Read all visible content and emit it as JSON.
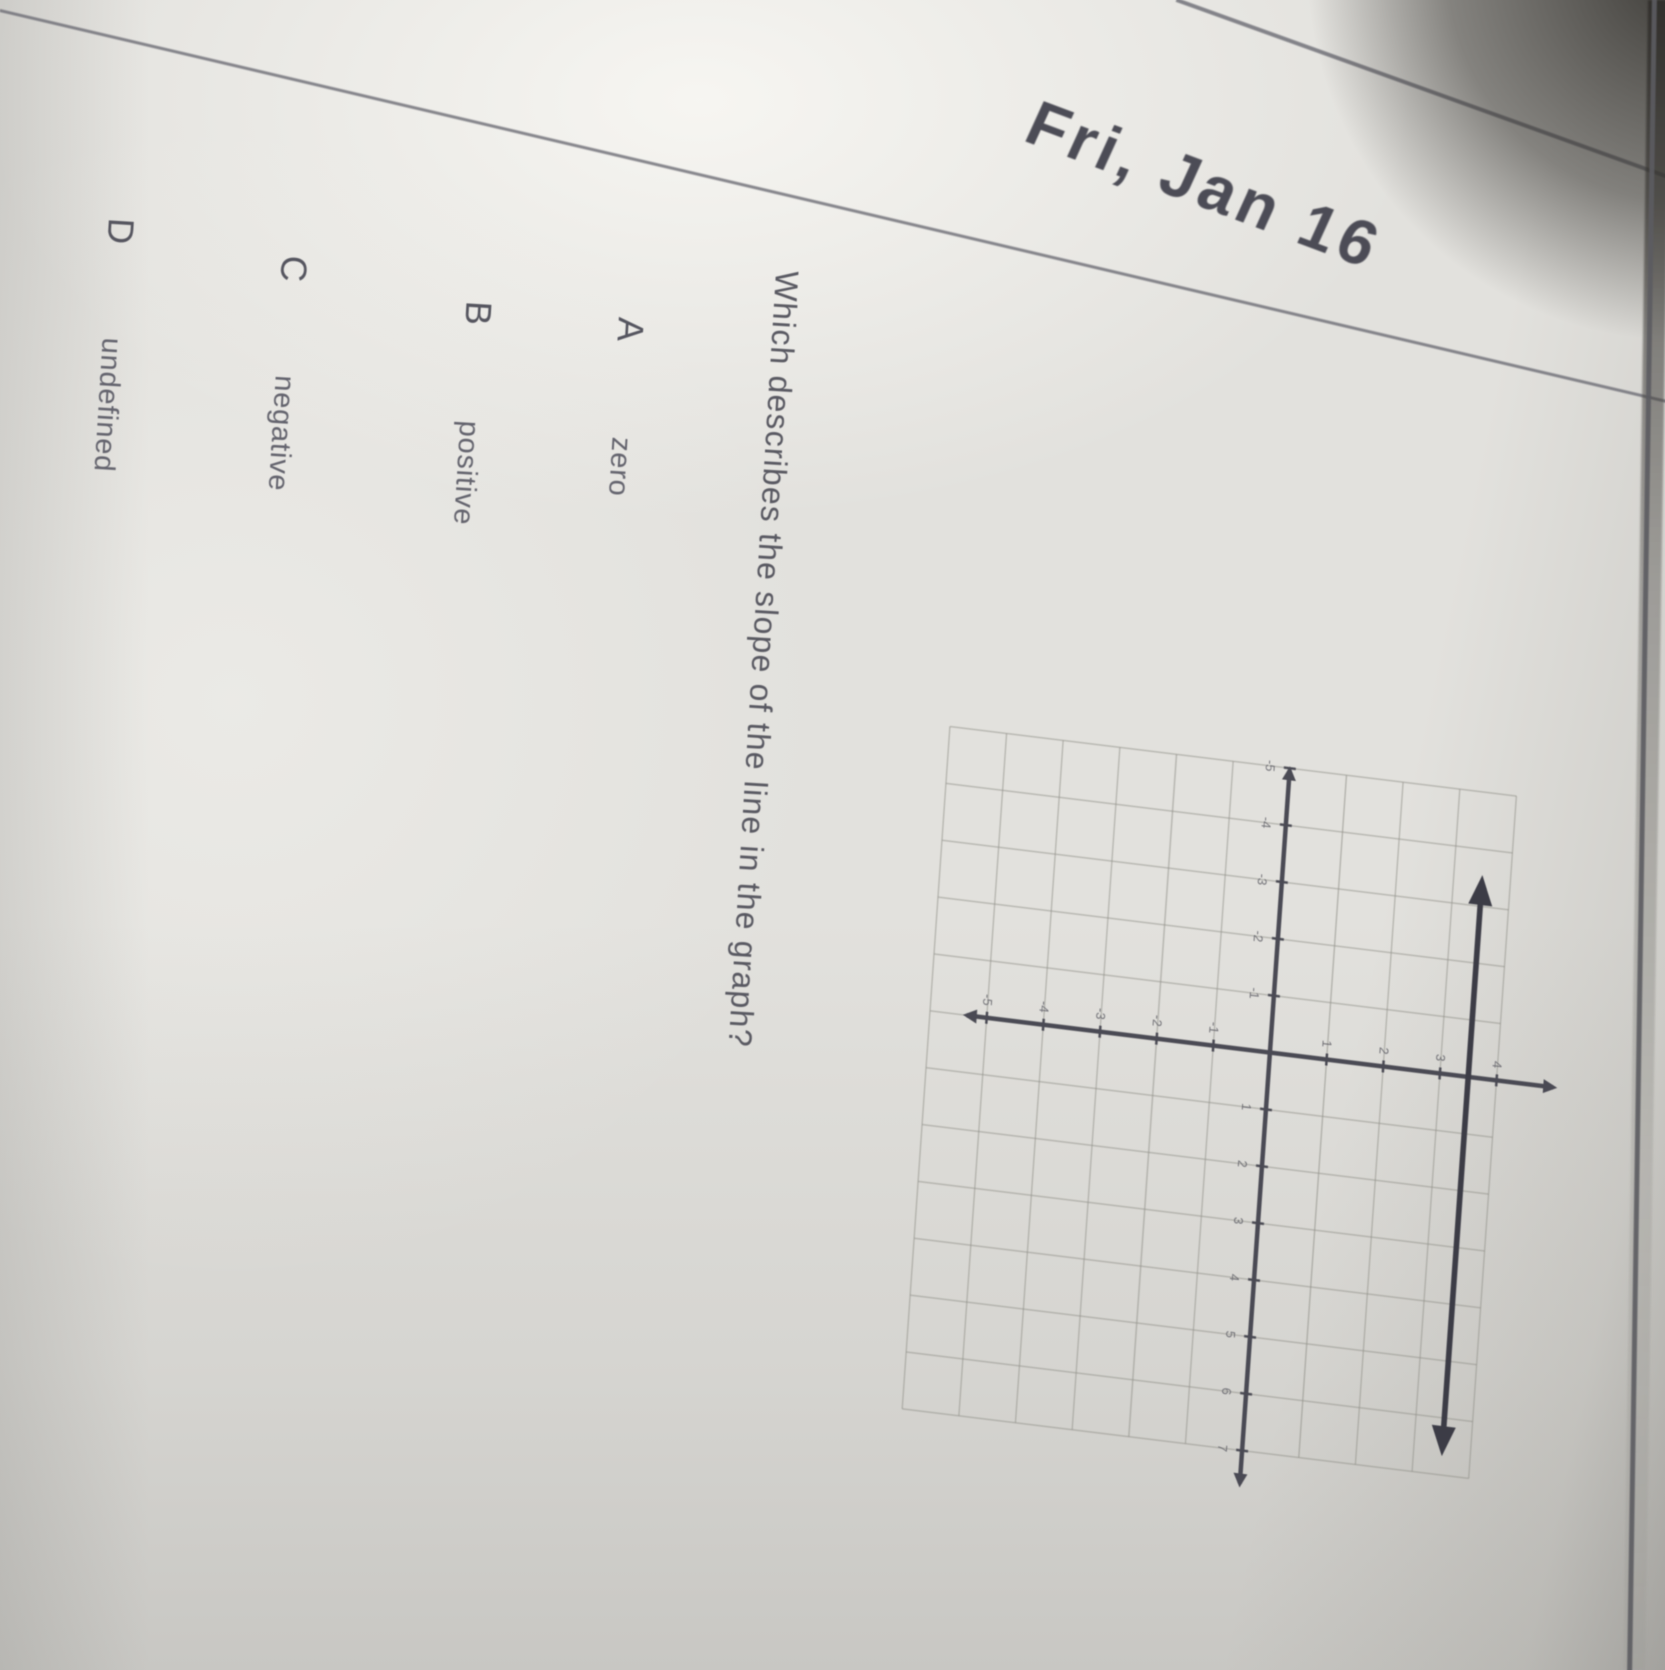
{
  "page": {
    "date_header": "Fri, Jan 16",
    "paper_color": "#e2e1dd",
    "ink_color": "#55555f",
    "ruled_line_color": "#6e6e76"
  },
  "question": {
    "text": "Which describes the slope of the line in the graph?"
  },
  "options": [
    {
      "letter": "A",
      "label": "zero"
    },
    {
      "letter": "B",
      "label": "positive"
    },
    {
      "letter": "C",
      "label": "negative"
    },
    {
      "letter": "D",
      "label": "undefined"
    }
  ],
  "chart_data": {
    "type": "line",
    "title": "",
    "xlabel": "",
    "ylabel": "",
    "description": "Coordinate grid with x- and y-axes; a single horizontal line with arrowheads on both ends drawn about 3.5 units above the x-axis (zero slope).",
    "x_range": [
      -5,
      7
    ],
    "y_range": [
      -6,
      4
    ],
    "grid": true,
    "grid_step": 1,
    "tick_labels_x": [
      -5,
      -4,
      -3,
      -2,
      -1,
      1,
      2,
      3,
      4,
      5,
      6,
      7
    ],
    "tick_labels_y": [
      -5,
      -4,
      -3,
      -2,
      -1,
      1,
      2,
      3,
      4
    ],
    "series": [
      {
        "name": "plotted-line",
        "orientation": "horizontal",
        "y": 3.5,
        "x_start": -3.55,
        "x_end": 6.67,
        "arrows": "both"
      }
    ],
    "axis_color": "#4a4a54",
    "grid_color": "#93928b",
    "line_color": "#3c3c46",
    "tick_label_color": "#63636a"
  }
}
